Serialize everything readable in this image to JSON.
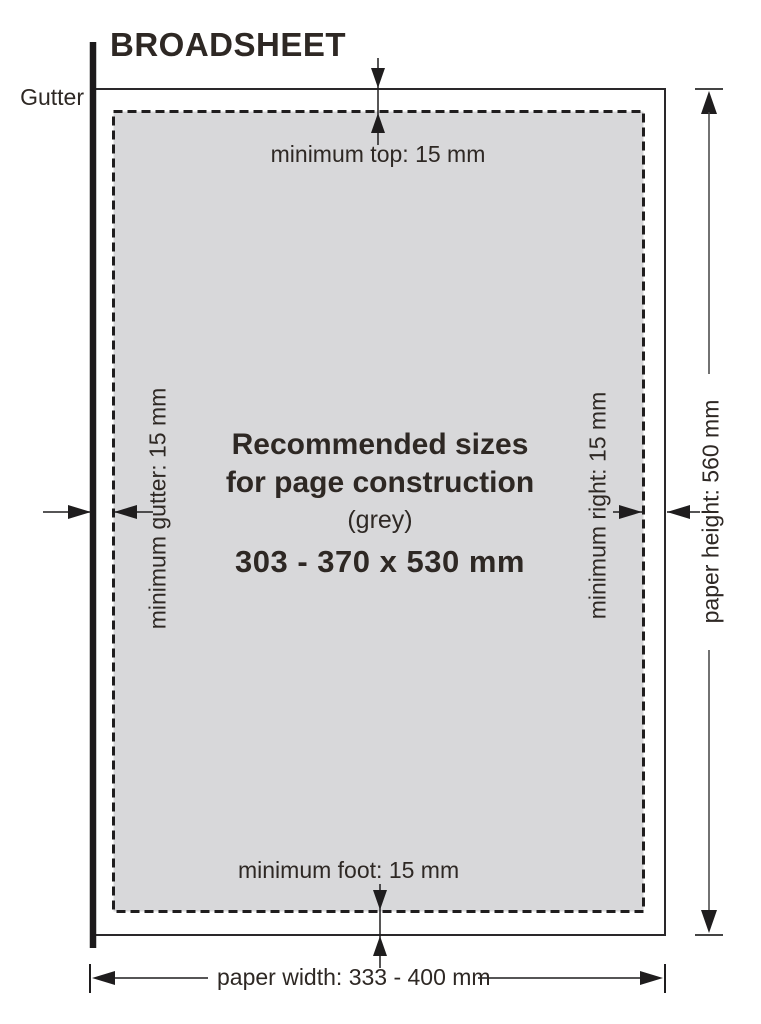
{
  "title": "BROADSHEET",
  "labels": {
    "gutter": "Gutter",
    "min_top": "minimum top: 15 mm",
    "min_foot": "minimum foot: 15 mm",
    "min_gutter": "minimum gutter: 15 mm",
    "min_right": "minimum right: 15 mm",
    "paper_height": "paper height: 560 mm",
    "paper_width": "paper width: 333 - 400 mm"
  },
  "center": {
    "line1": "Recommended sizes",
    "line2": "for page construction",
    "line3": "(grey)",
    "line4": "303 - 370 x 530 mm"
  },
  "colors": {
    "ink": "#2e2824",
    "line": "#1f1d1e",
    "grey_fill": "#d8d8da"
  }
}
